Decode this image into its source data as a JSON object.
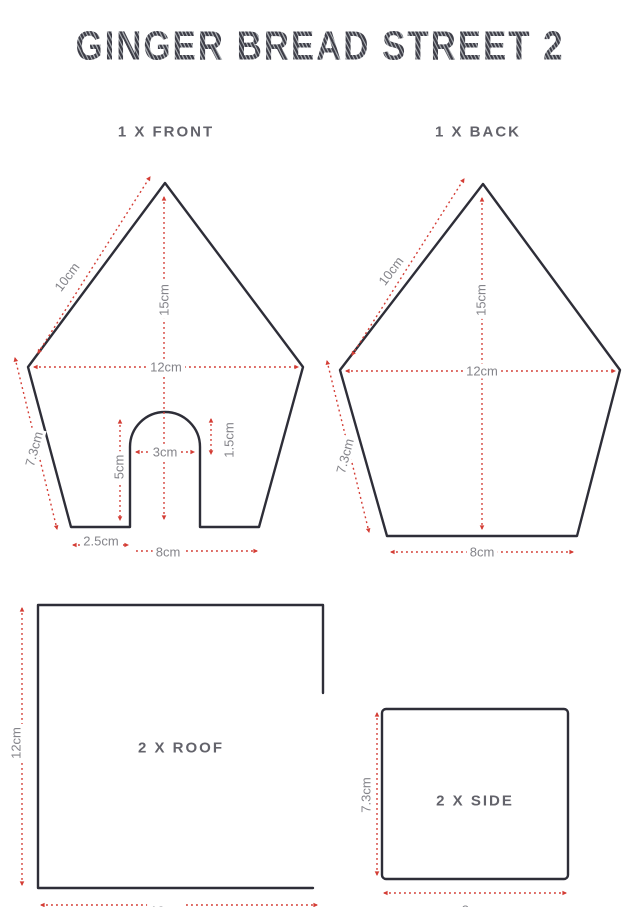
{
  "title": "GINGER BREAD STREET 2",
  "colors": {
    "dimension_red": "#d43d35",
    "outline_dark": "#2e2e38",
    "label_grey": "#84848a"
  },
  "front": {
    "heading": "1 X FRONT",
    "dims": {
      "slope": "10cm",
      "height": "15cm",
      "width": "12cm",
      "side": "7.3cm",
      "door_height": "5cm",
      "door_width": "3cm",
      "arch_height": "1.5cm",
      "ledge": "2.5cm",
      "base": "8cm"
    }
  },
  "back": {
    "heading": "1 X BACK",
    "dims": {
      "slope": "10cm",
      "height": "15cm",
      "width": "12cm",
      "side": "7.3cm",
      "base": "8cm"
    }
  },
  "roof": {
    "heading": "2 X ROOF",
    "dims": {
      "height": "12cm",
      "width": "10cm"
    }
  },
  "side": {
    "heading": "2 X SIDE",
    "dims": {
      "height": "7.3cm",
      "width": "8cm"
    }
  }
}
